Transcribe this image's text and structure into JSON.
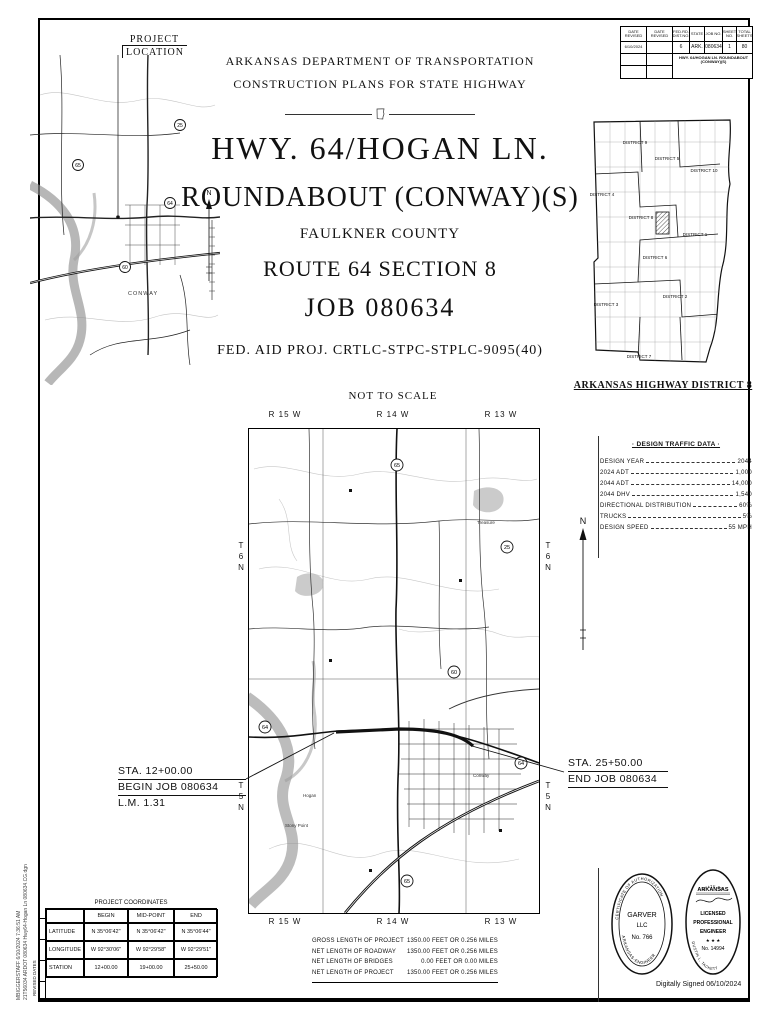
{
  "edge": {
    "line1": "MBIGGERSTAFF  6/10/2024  7:36:51 AM",
    "line2": "21T56034  ARDOT 080634 Hwy64-Hogan Ln  080634.CG.dgn",
    "revised": "REVISED DATES"
  },
  "rev_table": {
    "date_revised_1": "DATE REVISED",
    "date_revised_2": "DATE REVISED",
    "date_value": "6/10/2024",
    "fed_rd_header": "FED.RD. DIST.NO.",
    "state_header": "STATE",
    "job_no_header": "JOB NO.",
    "sheet_no_header": "SHEET NO.",
    "total_sheets_header": "TOTAL SHEETS",
    "fed_rd": "6",
    "state": "ARK.",
    "job_no": "080634",
    "sheet_no": "1",
    "total_sheets": "80",
    "project_name": "HWY. 64/HOGAN LN. ROUNDABOUT (CONWAY)(S)"
  },
  "project_location": {
    "line1": "PROJECT",
    "line2": "LOCATION"
  },
  "location_map": {
    "city": "CONWAY",
    "shields": [
      "65",
      "64",
      "60",
      "25"
    ]
  },
  "title": {
    "agency": "ARKANSAS DEPARTMENT OF TRANSPORTATION",
    "plans": "CONSTRUCTION PLANS FOR STATE HIGHWAY",
    "line1": "HWY. 64/HOGAN LN.",
    "line2": "ROUNDABOUT (CONWAY)(S)",
    "county": "FAULKNER COUNTY",
    "route": "ROUTE 64 SECTION 8",
    "job": "JOB 080634",
    "fed_aid": "FED. AID PROJ. CRTLC-STPC-STPLC-9095(40)",
    "scale_note": "NOT TO SCALE"
  },
  "state_map": {
    "caption": "ARKANSAS HIGHWAY DISTRICT 8",
    "districts": [
      "DISTRICT 9",
      "DISTRICT 5",
      "DISTRICT 10",
      "DISTRICT 4",
      "DISTRICT 8",
      "DISTRICT 1",
      "DISTRICT 6",
      "DISTRICT 2",
      "DISTRICT 3",
      "DISTRICT 7"
    ]
  },
  "main_map": {
    "north": "N",
    "ranges_top": [
      "R 15 W",
      "R 14 W",
      "R 13 W"
    ],
    "ranges_bottom": [
      "R 15 W",
      "R 14 W",
      "R 13 W"
    ],
    "townships_left": [
      "T 6 N",
      "T 5 N"
    ],
    "townships_right": [
      "T 6 N",
      "T 5 N"
    ],
    "shields": [
      "64",
      "65",
      "25",
      "65",
      "64",
      "60"
    ],
    "labels": {
      "treasure": "Treasure",
      "stony_point": "Stony Point",
      "conway": "Conway",
      "hogan": "Hogan"
    }
  },
  "design_traffic": {
    "title": "· DESIGN TRAFFIC DATA ·",
    "rows": [
      {
        "label": "DESIGN YEAR",
        "value": "2044"
      },
      {
        "label": "2024 ADT",
        "value": "1,000"
      },
      {
        "label": "2044 ADT",
        "value": "14,000"
      },
      {
        "label": "2044 DHV",
        "value": "1,540"
      },
      {
        "label": "DIRECTIONAL DISTRIBUTION",
        "value": "60%"
      },
      {
        "label": "TRUCKS",
        "value": "5%"
      },
      {
        "label": "DESIGN SPEED",
        "value": "55 MPH"
      }
    ]
  },
  "begin_annotation": {
    "sta": "STA. 12+00.00",
    "job": "BEGIN JOB 080634",
    "lm": "L.M. 1.31"
  },
  "end_annotation": {
    "sta": "STA. 25+50.00",
    "job": "END JOB 080634"
  },
  "coordinates": {
    "title": "PROJECT COORDINATES",
    "col_headers": [
      "BEGIN",
      "MID-POINT",
      "END"
    ],
    "rows": [
      {
        "label": "LATITUDE",
        "begin": "N 35°06'42\"",
        "mid": "N 35°06'42\"",
        "end": "N 35°06'44\""
      },
      {
        "label": "LONGITUDE",
        "begin": "W 92°30'06\"",
        "mid": "W 92°29'58\"",
        "end": "W 92°29'51\""
      },
      {
        "label": "STATION",
        "begin": "12+00.00",
        "mid": "19+00.00",
        "end": "25+50.00"
      }
    ]
  },
  "lengths": {
    "rows": [
      {
        "label": "GROSS LENGTH OF PROJECT",
        "value": "1350.00 FEET OR 0.256 MILES"
      },
      {
        "label": "NET LENGTH OF ROADWAY",
        "value": "1350.00 FEET OR 0.256 MILES"
      },
      {
        "label": "NET LENGTH OF BRIDGES",
        "value": "0.00 FEET OR 0.00 MILES"
      },
      {
        "label": "NET LENGTH OF PROJECT",
        "value": "1350.00 FEET OR 0.256 MILES"
      }
    ]
  },
  "seals": {
    "garver": {
      "arc_top": "CERTIFICATE OF AUTHORIZATION",
      "arc_bottom": "ARKANSAS-ENGINEER",
      "line1": "GARVER",
      "line2": "LLC",
      "line3": "No. 766"
    },
    "pe": {
      "top_arc": "STATE OF",
      "state": "ARKANSAS",
      "lic1": "LICENSED",
      "lic2": "PROFESSIONAL",
      "lic3": "ENGINEER",
      "stars": "★ ★ ★",
      "number": "No. 14994",
      "name_arc": "DUSTIN L. TACKETT"
    },
    "signed": "Digitally Signed 06/10/2024"
  }
}
